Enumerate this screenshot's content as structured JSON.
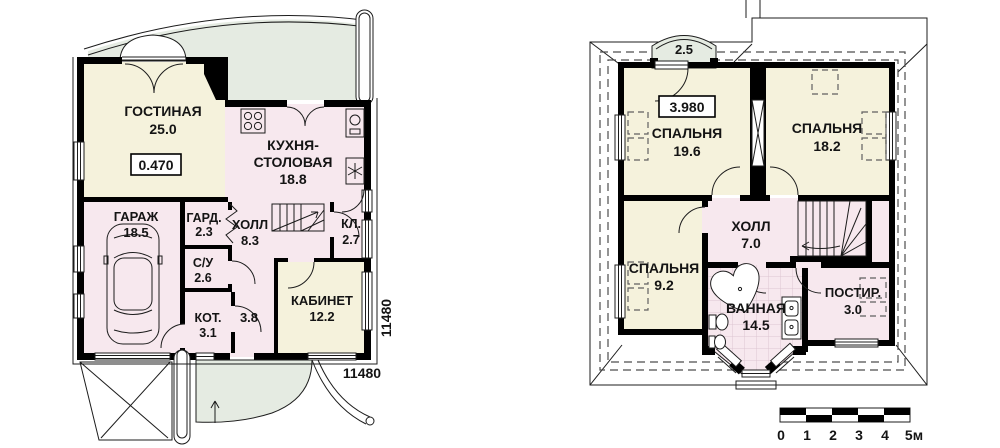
{
  "document": {
    "type": "house-floor-plans",
    "language": "ru"
  },
  "colors": {
    "walls": "#000000",
    "warm_rooms": "#f5f2dc",
    "wet_rooms": "#f7e8ee",
    "terrace": "#e5ebe2",
    "background": "#ffffff"
  },
  "floor1": {
    "elevation": "0.470",
    "dim_bottom": "11480",
    "dim_right": "11480",
    "rooms": {
      "living": {
        "label": "ГОСТИНАЯ",
        "area": "25.0"
      },
      "kitchen": {
        "label1": "КУХНЯ-",
        "label2": "СТОЛОВАЯ",
        "area": "18.8"
      },
      "garage": {
        "label": "ГАРАЖ",
        "area": "18.5"
      },
      "wardrobe": {
        "label": "ГАРД.",
        "area": "2.3"
      },
      "hall": {
        "label": "ХОЛЛ",
        "area": "8.3"
      },
      "closet": {
        "label": "КЛ.",
        "area": "2.7"
      },
      "wc": {
        "label": "С/У",
        "area": "2.6"
      },
      "boiler": {
        "label": "КОТ.",
        "area": "3.1"
      },
      "corridor": {
        "area": "3.8"
      },
      "study": {
        "label": "КАБИНЕТ",
        "area": "12.2"
      }
    }
  },
  "floor2": {
    "elevation": "3.980",
    "balcony": {
      "area": "2.5"
    },
    "rooms": {
      "bedroom1": {
        "label": "СПАЛЬНЯ",
        "area": "19.6"
      },
      "bedroom2": {
        "label": "СПАЛЬНЯ",
        "area": "18.2"
      },
      "hall": {
        "label": "ХОЛЛ",
        "area": "7.0"
      },
      "bedroom3": {
        "label": "СПАЛЬНЯ",
        "area": "9.2"
      },
      "bath": {
        "label": "ВАННАЯ",
        "area": "14.5"
      },
      "laundry": {
        "label": "ПОСТИР.",
        "area": "3.0"
      }
    }
  },
  "scalebar": {
    "t0": "0",
    "t1": "1",
    "t2": "2",
    "t3": "3",
    "t4": "4",
    "t5": "5м"
  }
}
